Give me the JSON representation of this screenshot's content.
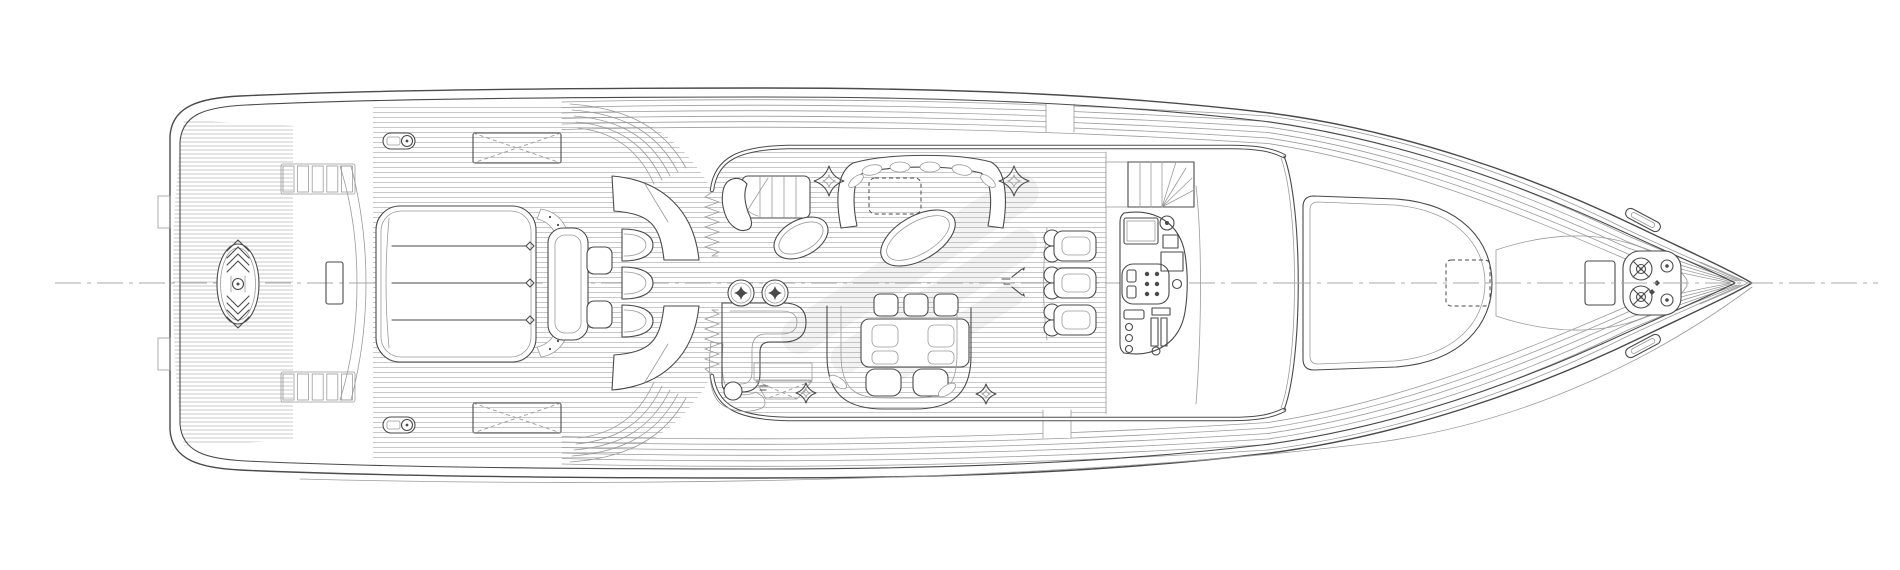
{
  "colors": {
    "line": "#4a4a4a",
    "line_light": "#9b9b9b",
    "bg": "#ffffff",
    "centerline": "#a8a8a8",
    "hatch": "#6e6e6e",
    "stipple": "#7a7a7a",
    "watermark": "#666666"
  }
}
